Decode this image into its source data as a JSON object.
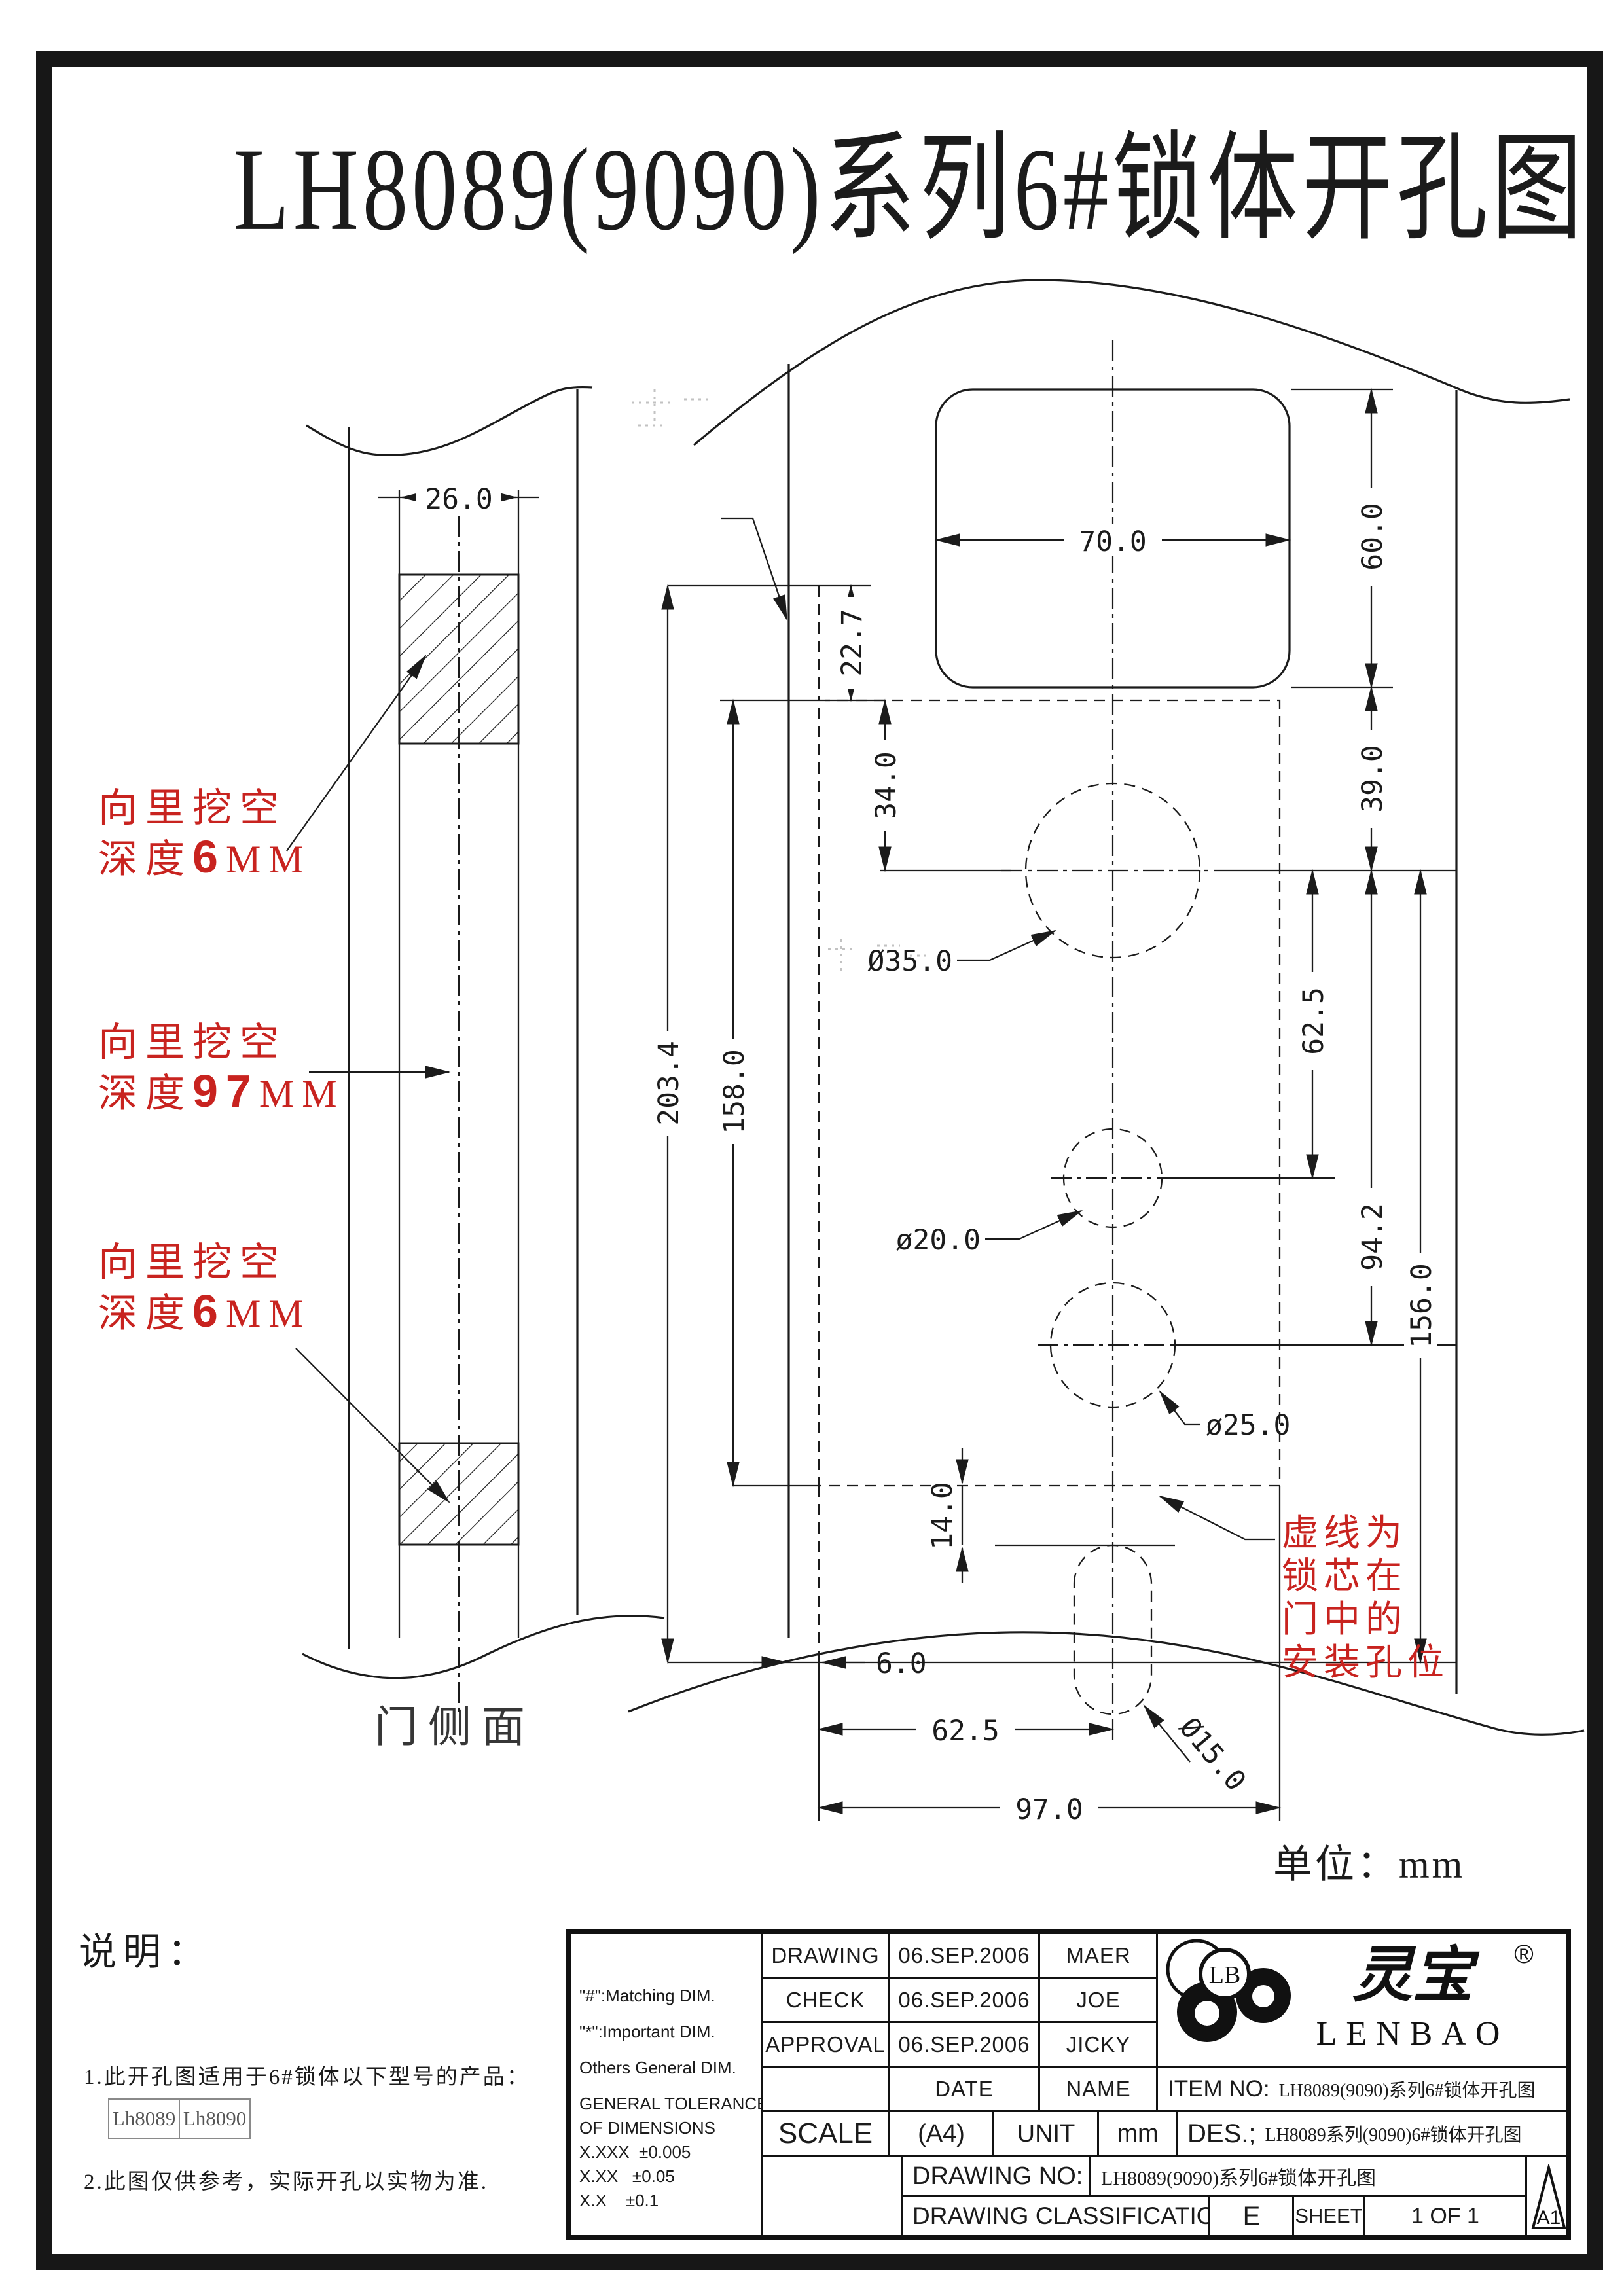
{
  "page": {
    "title": "LH8089(9090)系列6#锁体开孔图",
    "unit_note": "单位：mm"
  },
  "side_view": {
    "label": "门侧面"
  },
  "red": {
    "top": {
      "l1": "向里挖空",
      "l2pre": "深度",
      "l2val": "6",
      "l2unit": "MM"
    },
    "mid": {
      "l1": "向里挖空",
      "l2pre": "深度",
      "l2val": "97",
      "l2unit": "MM"
    },
    "bot": {
      "l1": "向里挖空",
      "l2pre": "深度",
      "l2val": "6",
      "l2unit": "MM"
    },
    "note": {
      "l1": "虚线为",
      "l2": "锁芯在",
      "l3": "门中的",
      "l4": "安装孔位"
    }
  },
  "dims": {
    "strip_width": "26.0",
    "handle_w": "70.0",
    "handle_h": "60.0",
    "off_227": "22.7",
    "off_340": "34.0",
    "off_390": "39.0",
    "total_h": "203.4",
    "cut_h": "158.0",
    "sp_625r": "62.5",
    "sp_942": "94.2",
    "sp_1560": "156.0",
    "dia35": "Ø35.0",
    "dia20": "ø20.0",
    "dia25": "ø25.0",
    "dia15": "Ø15.0",
    "off_140": "14.0",
    "gap_60": "6.0",
    "sp_625b": "62.5",
    "body_w": "97.0"
  },
  "notes": {
    "heading": "说明：",
    "item1": "1.此开孔图适用于6#锁体以下型号的产品：",
    "models": [
      "Lh8089",
      "Lh8090"
    ],
    "item2": "2.此图仅供参考，实际开孔以实物为准."
  },
  "title_block": {
    "legend": [
      "\"#\":Matching  DIM.",
      "\"*\":Important  DIM.",
      "Others General  DIM."
    ],
    "tolerance": {
      "l1": "GENERAL TOLERANCE",
      "l2": "OF DIMENSIONS",
      "rows": [
        [
          "X.XXX",
          "±0.005"
        ],
        [
          "X.XX",
          "±0.05"
        ],
        [
          "X.X",
          "±0.1"
        ]
      ]
    },
    "approvals": [
      {
        "label": "DRAWING",
        "date": "06.SEP.2006",
        "name": "MAER"
      },
      {
        "label": "CHECK",
        "date": "06.SEP.2006",
        "name": "JOE"
      },
      {
        "label": "APPROVAL",
        "date": "06.SEP.2006",
        "name": "JICKY"
      }
    ],
    "date_label": "DATE",
    "name_label": "NAME",
    "item_no_label": "ITEM NO:",
    "item_no_value": "LH8089(9090)系列6#锁体开孔图",
    "scale_label": "SCALE",
    "scale_value": "(A4)",
    "unit_label": "UNIT",
    "unit_value": "mm",
    "des_label": "DES.;",
    "des_value": "LH8089系列(9090)6#锁体开孔图",
    "drawing_no_label": "DRAWING NO:",
    "drawing_no_value": "LH8089(9090)系列6#锁体开孔图",
    "classification_label": "DRAWING CLASSIFICATION",
    "classification_value": "E",
    "sheet_label": "SHEET",
    "sheet_value": "1 OF 1",
    "format_code": "A1"
  },
  "logo": {
    "monogram": "LB",
    "cn_name": "灵宝",
    "latin_name": "LENBAO",
    "registered": "®"
  }
}
